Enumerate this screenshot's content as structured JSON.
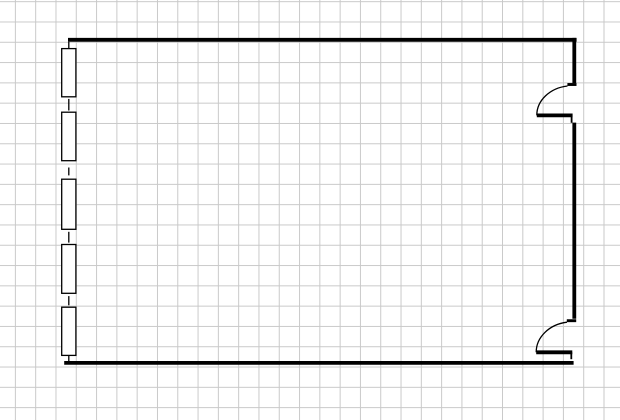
{
  "canvas": {
    "width": 620,
    "height": 420,
    "background_color": "#ffffff",
    "grid": {
      "spacing_x": 20.3,
      "spacing_y": 20.3,
      "offset_x": 14.9,
      "offset_y": 1.2,
      "line_color": "#c9c9c9"
    }
  },
  "floor_plan": {
    "stroke_color": "#000000",
    "window_fill": "#ffffff",
    "walls": [
      {
        "name": "wall-top",
        "x1": 68,
        "y1": 39.8,
        "x2": 576.6,
        "y2": 39.8,
        "width": 3.9
      },
      {
        "name": "wall-bottom",
        "x1": 64.2,
        "y1": 362.9,
        "x2": 573.6,
        "y2": 362.9,
        "width": 3.7
      },
      {
        "name": "wall-right-upper",
        "x1": 574.3,
        "y1": 37.9,
        "x2": 574.3,
        "y2": 83,
        "width": 3.8
      },
      {
        "name": "wall-right-middle",
        "x1": 574.3,
        "y1": 122.6,
        "x2": 574.3,
        "y2": 318.8,
        "width": 3.8
      }
    ],
    "left_wall": {
      "x": 68.8,
      "width": 1.3,
      "segments": [
        [
          41.8,
          48.8
        ],
        [
          98.9,
          110.5
        ],
        [
          167.5,
          175.4
        ],
        [
          231.8,
          242.6
        ],
        [
          296.1,
          305.3
        ],
        [
          355.3,
          362.2
        ]
      ]
    },
    "windows": {
      "x": 61.7,
      "width": 14.2,
      "stroke_width": 1.3,
      "items": [
        {
          "y": 48.6,
          "height": 48.2
        },
        {
          "y": 112.2,
          "height": 48.5
        },
        {
          "y": 179.2,
          "height": 50.1
        },
        {
          "y": 244.5,
          "height": 48.8
        },
        {
          "y": 307.2,
          "height": 48.2
        }
      ]
    },
    "doors": [
      {
        "name": "door-top-right",
        "jamb": {
          "x1": 567.4,
          "y1": 84.5,
          "x2": 576.5,
          "y2": 84.5,
          "width": 2.9
        },
        "swing_arc": {
          "path": "M 536.8 115.4 A 35.5 29.5 0 0 1 567.5 86",
          "width": 1.3
        },
        "leaf": {
          "x1": 536.8,
          "y1": 115.4,
          "x2": 572.6,
          "y2": 115.4,
          "width": 3.8
        },
        "stop": {
          "x1": 571.6,
          "y1": 115.4,
          "x2": 571.6,
          "y2": 122.8,
          "width": 1.8
        }
      },
      {
        "name": "door-bottom-right",
        "jamb": {
          "x1": 566.8,
          "y1": 320.7,
          "x2": 576.2,
          "y2": 320.7,
          "width": 2.9
        },
        "swing_arc": {
          "path": "M 536.2 352.3 A 36 30.3 0 0 1 567 322.2",
          "width": 1.3
        },
        "leaf": {
          "x1": 536.2,
          "y1": 352.3,
          "x2": 572.3,
          "y2": 352.3,
          "width": 3.8
        },
        "stop": {
          "x1": 571.3,
          "y1": 352.3,
          "x2": 571.3,
          "y2": 359.2,
          "width": 1.8
        }
      }
    ]
  }
}
